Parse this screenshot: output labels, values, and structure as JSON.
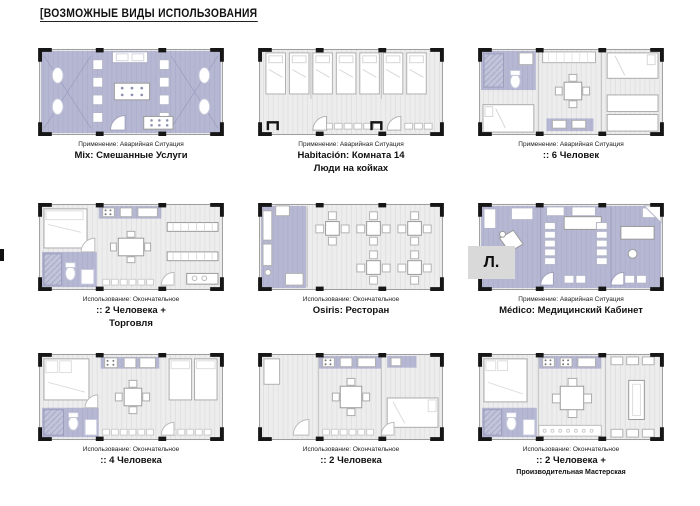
{
  "page": {
    "title": "[ВОЗМОЖНЫЕ ВИДЫ ИСПОЛЬЗОВАНИЯ"
  },
  "colors": {
    "lavender_zone": "#b6b8d3",
    "floor_grey": "#ededed",
    "frame_black": "#161616"
  },
  "plans": [
    {
      "id": "mix-services",
      "usage_label": "Применение: Аварийная Ситуация",
      "title": "Mix: Смешанные Услуги",
      "subtitle": ""
    },
    {
      "id": "habitacion-room-14",
      "usage_label": "Применение: Аварийная Ситуация",
      "title": "Habitación: Комната 14",
      "subtitle": "Люди на койках"
    },
    {
      "id": "six-people",
      "usage_label": "Применение: Аварийная Ситуация",
      "title": ":: 6 Человек",
      "subtitle": ""
    },
    {
      "id": "two-people-trade",
      "usage_label": "Использование: Окончательное",
      "title": ":: 2 Человека +",
      "subtitle": "Торговля"
    },
    {
      "id": "osiris-restaurant",
      "usage_label": "Использование: Окончательное",
      "title": "Osiris: Ресторан",
      "subtitle": ""
    },
    {
      "id": "medico-cabinet",
      "usage_label": "Применение: Аварийная Ситуация",
      "title": "Médico: Медицинский Кабинет",
      "subtitle": "",
      "mark": "Л."
    },
    {
      "id": "four-people",
      "usage_label": "Использование: Окончательное",
      "title": ":: 4 Человека",
      "subtitle": ""
    },
    {
      "id": "two-people",
      "usage_label": "Использование: Окончательное",
      "title": ":: 2 Человека",
      "subtitle": ""
    },
    {
      "id": "two-people-workshop",
      "usage_label": "Использование: Окончательное",
      "title": ":: 2 Человека +",
      "subtitle": "Производительная Мастерская"
    }
  ]
}
